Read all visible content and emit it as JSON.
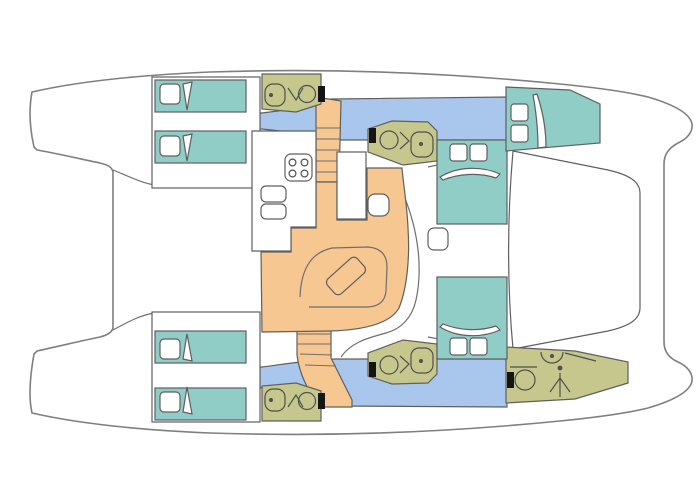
{
  "diagram": {
    "type": "catamaran-deck-floor-plan",
    "orientation": "bow-right-stern-left",
    "colors": {
      "background": "#ffffff",
      "hull_fill": "#ffffff",
      "outline": "#7f7f7f",
      "cabin": "#8fcdc6",
      "corridor": "#a9c7ec",
      "salon": "#f7c791",
      "bathroom": "#c6c78c",
      "door": "#151515",
      "icon_dot": "#4f4f4f"
    },
    "rooms": [
      {
        "name": "aft-cabin-port",
        "kind": "cabin-two-berths"
      },
      {
        "name": "aft-cabin-starboard",
        "kind": "cabin-two-berths"
      },
      {
        "name": "aft-bathroom-port",
        "kind": "head"
      },
      {
        "name": "aft-bathroom-starboard",
        "kind": "head"
      },
      {
        "name": "mid-bathroom-port",
        "kind": "head"
      },
      {
        "name": "mid-bathroom-starboard",
        "kind": "head"
      },
      {
        "name": "bow-cabin-port",
        "kind": "cabin"
      },
      {
        "name": "bow-bathroom-starboard",
        "kind": "head-with-shower"
      },
      {
        "name": "salon-galley",
        "kind": "saloon"
      },
      {
        "name": "foredeck-trampoline",
        "kind": "deck"
      }
    ],
    "icons": [
      "stove-icon",
      "sink-icon",
      "toilet-icon",
      "shower-icon",
      "hatch-icon",
      "pillow",
      "stairs",
      "table",
      "sofa",
      "door-marker"
    ]
  }
}
